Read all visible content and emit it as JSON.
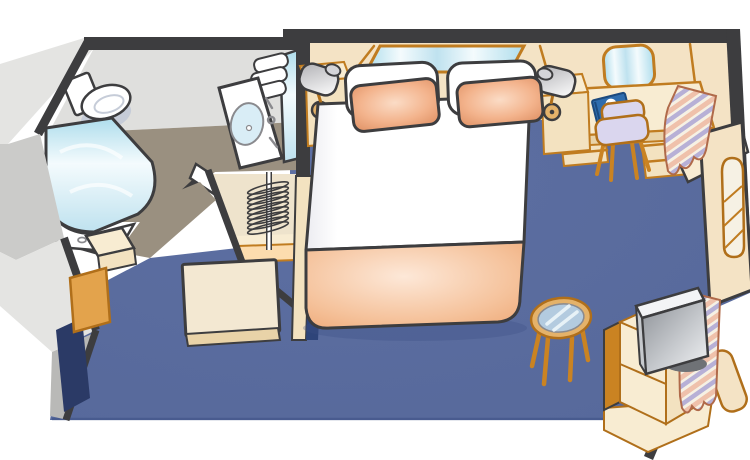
{
  "meta": {
    "type": "floor-plan-illustration",
    "subject": "cruise-ship-stateroom",
    "view": "isometric-cutaway",
    "label": "Stateroom floor plan"
  },
  "colors": {
    "wall_dark": "#3d3d3f",
    "carpet": "#56689a",
    "carpet_light": "#5d6fa2",
    "carpet_shadow": "#3d5086",
    "carpet_dark": "#2e4479",
    "navy_sliver": "#2b3a66",
    "wall_cream": "#f4e3c5",
    "wall_trim": "#c07c20",
    "furniture_cream": "#f8ecd2",
    "furniture_tan": "#f3e2c0",
    "furniture_edge": "#e9d3a8",
    "shelf_peach": "#fcdcae",
    "closet_cream": "#eee3cc",
    "door_cream": "#f3e8d2",
    "wood_orange": "#ca8322",
    "wood_outline": "#b06f1a",
    "cabinet_orange": "#e3a34c",
    "outer_gray_light": "#e4e4e2",
    "outer_gray_mid": "#cbcbc9",
    "outer_gray_dark": "#b9b9b7",
    "bath_wall": "#dfdfdd",
    "bath_floor": "#9a9080",
    "white": "#ffffff",
    "white_soft": "#ececf1",
    "toilet_shadow": "#c6ccd8",
    "chrome": "#8a8a8e",
    "glass_1": "#aeddec",
    "glass_2": "#f4fbfd",
    "glass_3": "#bfe2ef",
    "sink_blue": "#d9edf6",
    "cushion_light": "#fbdcc6",
    "cushion_mid": "#f3b38c",
    "cushion_edge": "#dd8d60",
    "blanket_light": "#fde8d8",
    "blanket_mid": "#f5c29b",
    "blanket_edge": "#eda470",
    "chair_lavender": "#dad6ee",
    "curtain_cream": "#f6f1e4",
    "curtain_pink": "#efc1ab",
    "curtain_lavender": "#b7b0d6",
    "curtain_outline": "#b06a4a",
    "tv_dark": "#8d9197",
    "tv_gray": "#c6c9cd",
    "tv_light": "#f3f4f6",
    "tv_base": "#6f7276",
    "lamp_gray": "#b0b0b4",
    "lamp_cap": "#d4d4d8",
    "book_blue": "#2f6dae",
    "book_edge": "#1c4a7e",
    "table_wood": "#e4b26a",
    "table_glass": "#b3cbdf"
  },
  "rooms": {
    "bedroom": {
      "label": "bedroom"
    },
    "bathroom": {
      "label": "bathroom"
    },
    "closet": {
      "label": "closet"
    },
    "entry": {
      "label": "entry"
    }
  },
  "furniture": {
    "bed": {
      "label": "double-bed"
    },
    "pillows": {
      "label": "pillows"
    },
    "cushions": {
      "label": "accent-cushions"
    },
    "blanket": {
      "label": "folded-blanket"
    },
    "nightstand_left": {
      "label": "left-nightstand"
    },
    "nightstand_right": {
      "label": "right-nightstand"
    },
    "lamp_left": {
      "label": "left-reading-lamp"
    },
    "lamp_right": {
      "label": "right-reading-lamp"
    },
    "mirror_bed": {
      "label": "wall-mirror-above-bed"
    },
    "mirror_desk": {
      "label": "vanity-mirror-above-desk"
    },
    "desk": {
      "label": "writing-desk"
    },
    "desk_chair": {
      "label": "desk-chair"
    },
    "book": {
      "label": "cruise-directory-book"
    },
    "closet_hangers": {
      "label": "closet-hanger-rod"
    },
    "toilet": {
      "label": "toilet"
    },
    "shower": {
      "label": "shower-with-curved-glass-door"
    },
    "sink": {
      "label": "vanity-sink"
    },
    "towels": {
      "label": "towel-stack"
    },
    "entry_door": {
      "label": "open-entry-door"
    },
    "entry_cabinet": {
      "label": "entry-cabinet"
    },
    "curtain_upper": {
      "label": "striped-curtain-upper"
    },
    "curtain_lower": {
      "label": "striped-curtain-lower"
    },
    "balcony_door": {
      "label": "arched-window-door"
    },
    "tv": {
      "label": "flat-screen-tv"
    },
    "tv_cabinet": {
      "label": "tv-cabinet"
    },
    "table": {
      "label": "round-glass-table"
    }
  }
}
